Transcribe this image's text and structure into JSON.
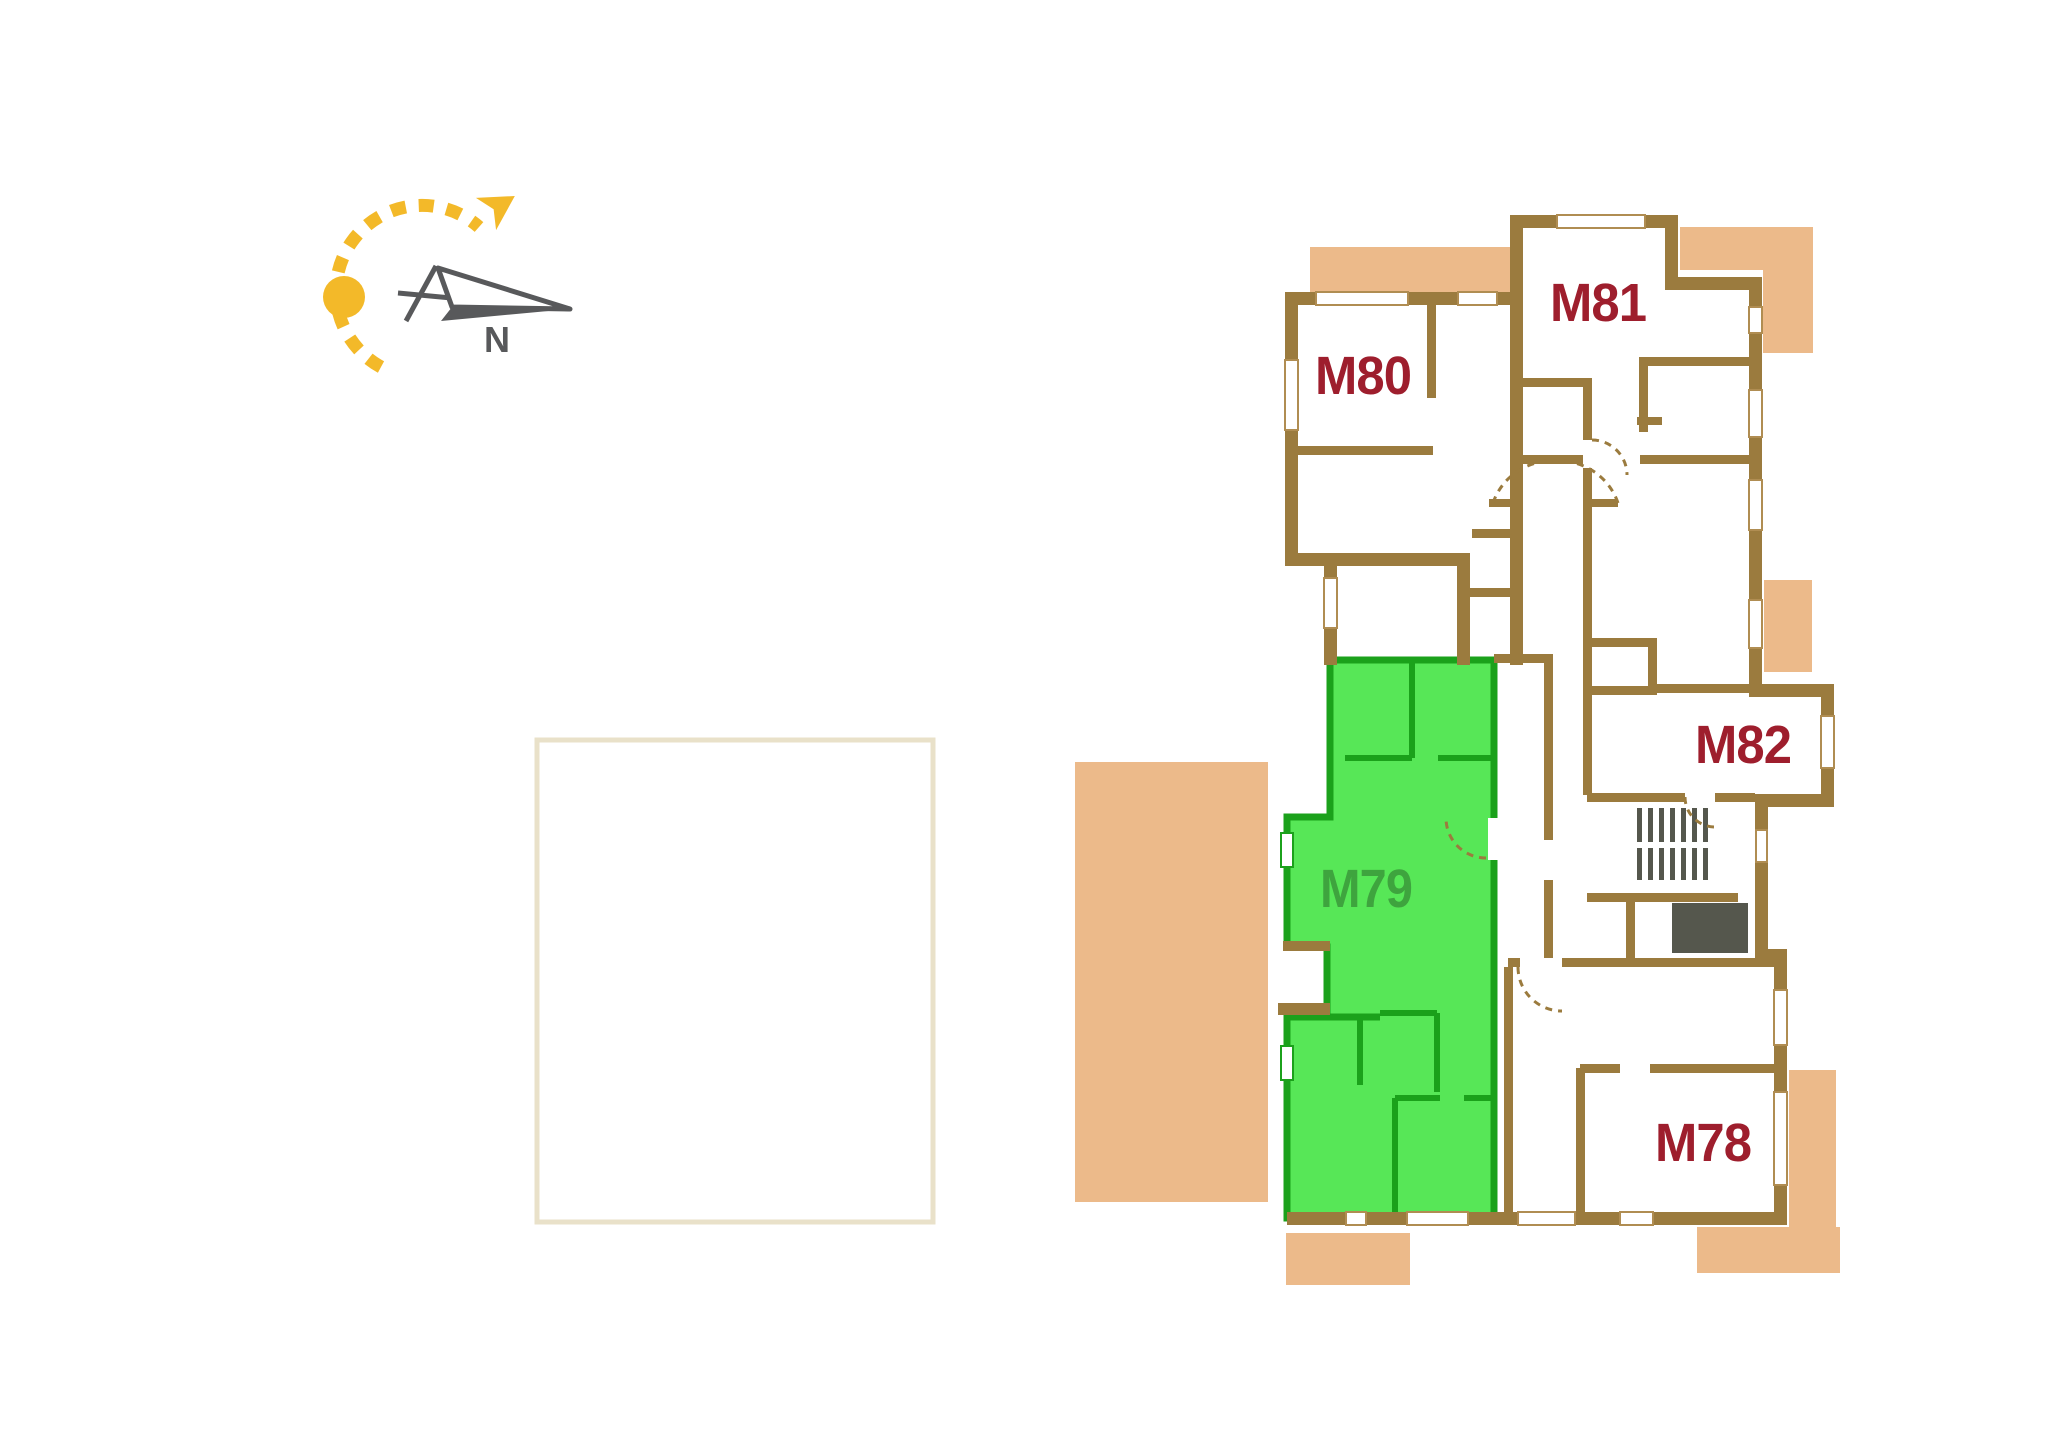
{
  "plan": {
    "type": "apartment-floor-plan",
    "units": [
      {
        "id": "M78",
        "label": "M78",
        "state": "normal"
      },
      {
        "id": "M79",
        "label": "M79",
        "state": "highlighted"
      },
      {
        "id": "M80",
        "label": "M80",
        "state": "normal"
      },
      {
        "id": "M81",
        "label": "M81",
        "state": "normal"
      },
      {
        "id": "M82",
        "label": "M82",
        "state": "normal"
      }
    ]
  },
  "compass": {
    "north_label": "N"
  },
  "colors": {
    "wall_brown": "#9B7B3E",
    "window_outline": "#B08D52",
    "balcony_tan": "#ECBA8A",
    "highlight_fill": "#57E757",
    "highlight_wall": "#1BA11B",
    "highlight_label": "#3EA43E",
    "unit_label_red": "#9E1E2D",
    "compass_yellow": "#F3B929",
    "compass_gray": "#58595B",
    "stair_gray": "#55574D",
    "plot_outline": "#E9E1C9"
  }
}
